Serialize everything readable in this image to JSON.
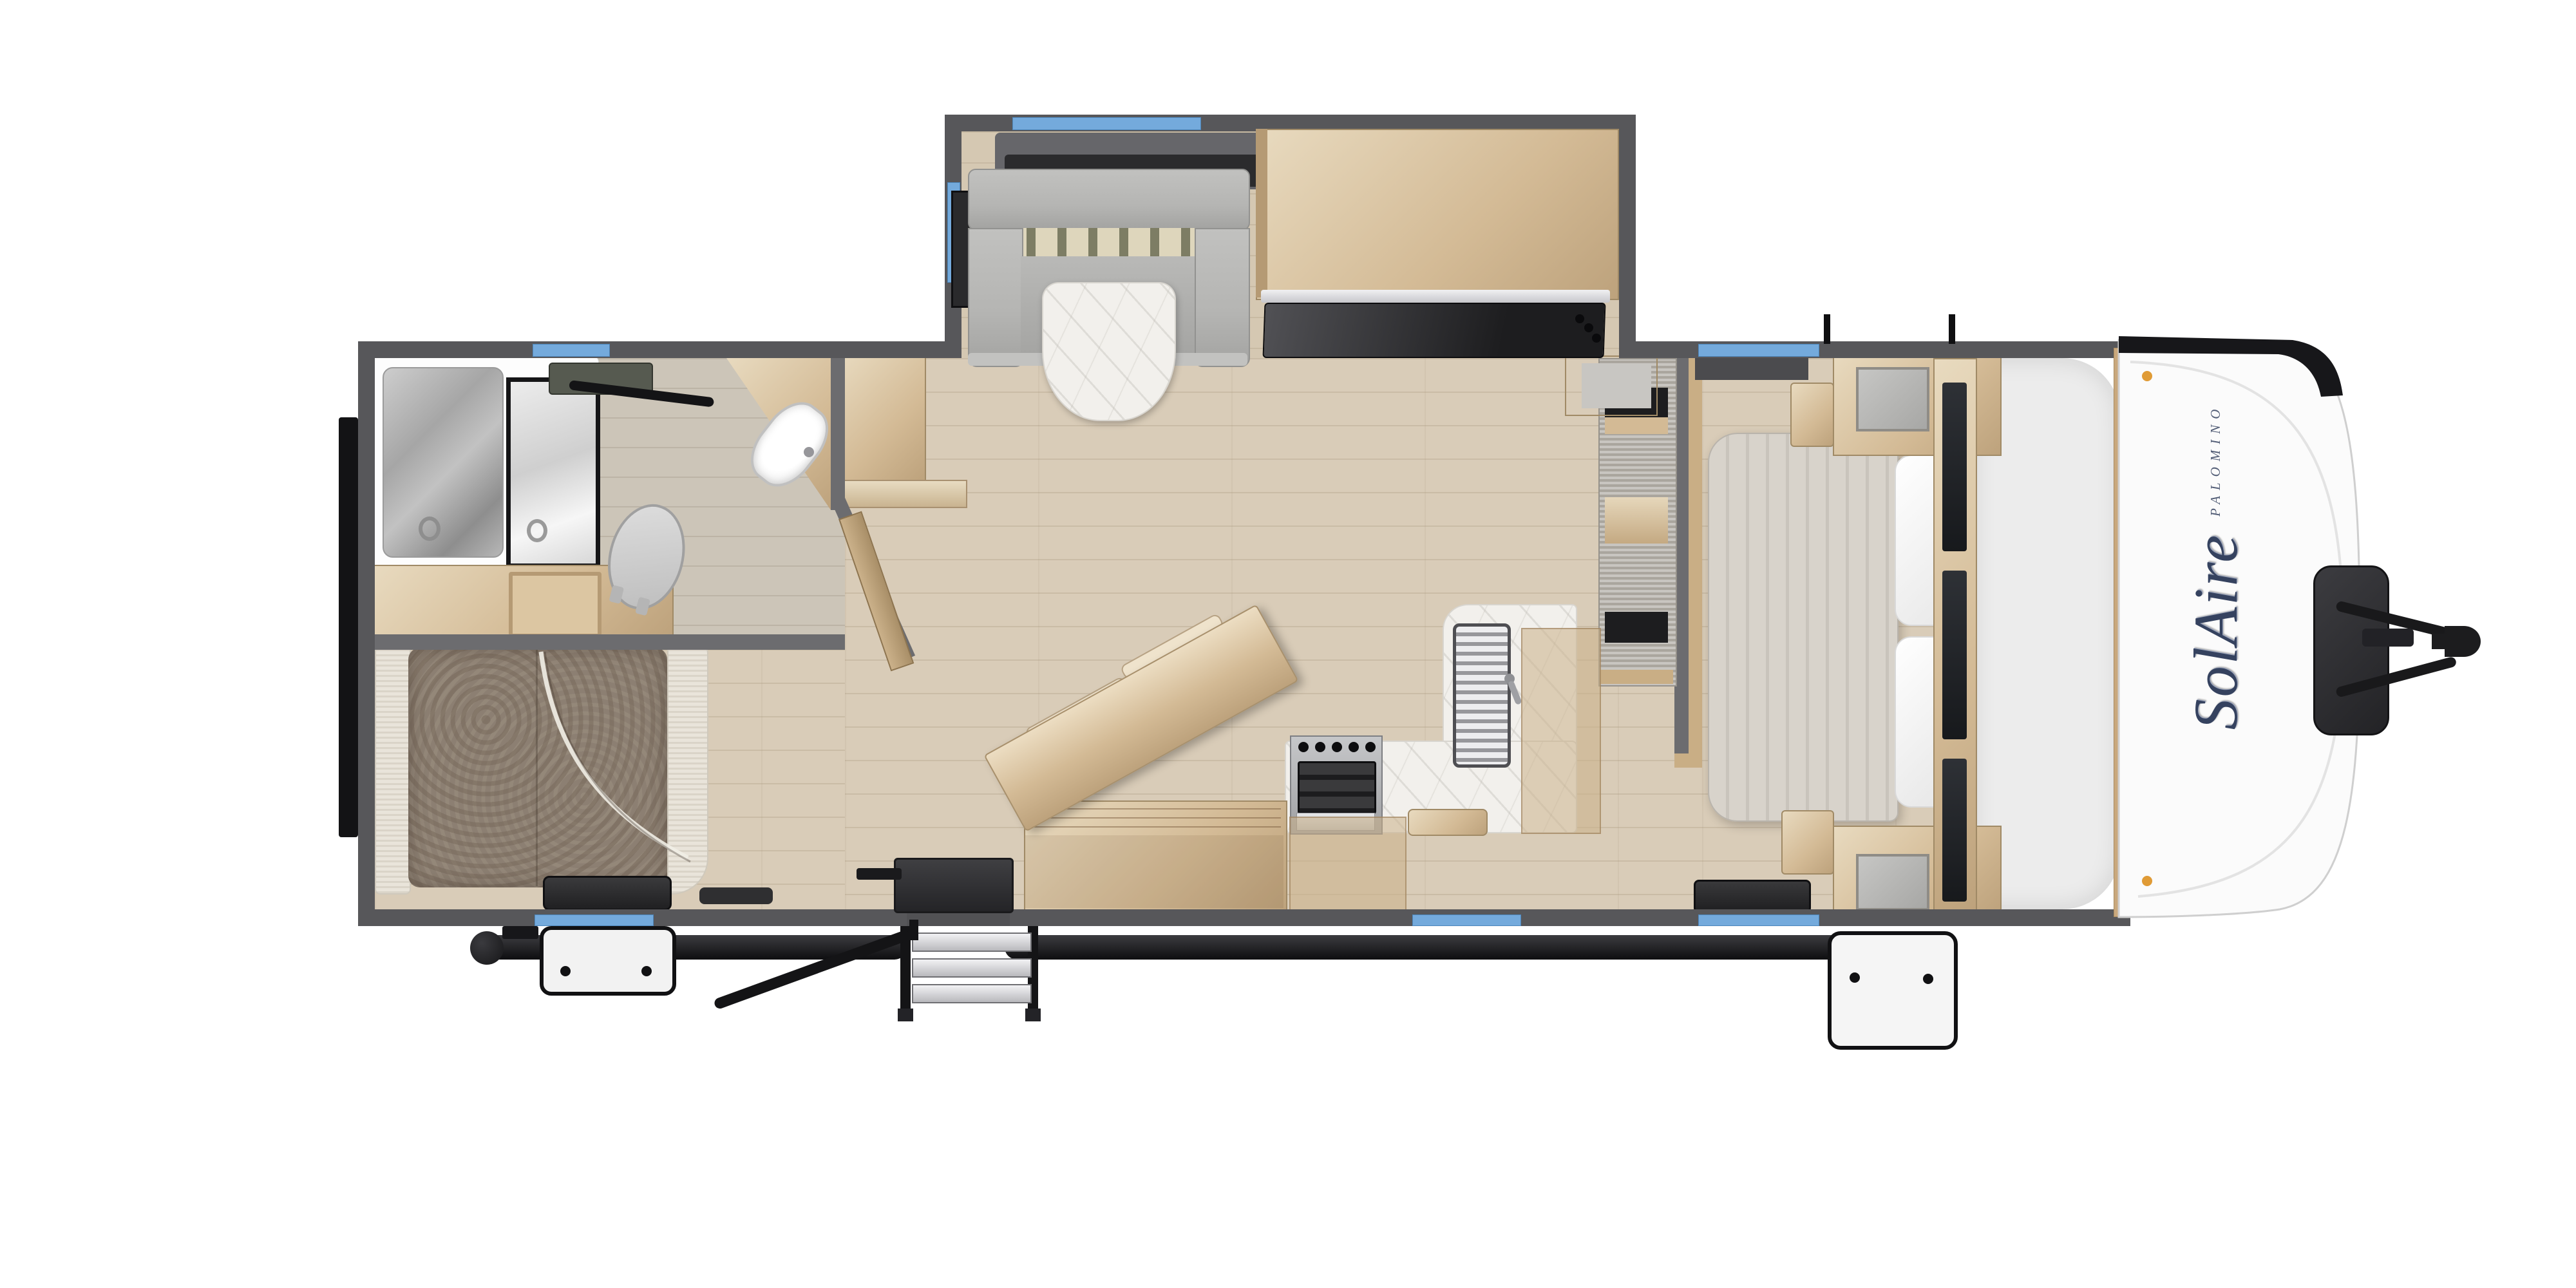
{
  "title": "Travel trailer floor plan (top-down rendering)",
  "brand": {
    "logo_text": "SolAire",
    "maker_text": "PALOMINO"
  },
  "colors": {
    "wall": "#57575a",
    "partition": "#6c6c6f",
    "floor": "#d9ccb8",
    "floor_bath": "#ccc5b8",
    "floor_slide": "#d5c8b2",
    "wood": "#d3ba95",
    "wood_light": "#e6d7bb",
    "wood_dark": "#b59a74",
    "counter": "#f2f0ec",
    "sofa": "#b5b5b3",
    "shag": "#8c7f72",
    "arm": "#e9e4da",
    "bed": "#d8d3cb",
    "window": "#74aadc",
    "navy": "#35425f",
    "black": "#161618",
    "storage": "#ececec",
    "amber_marker": "#e09b36"
  },
  "rooms": {
    "bathroom": {
      "fixtures": [
        "shower",
        "toilet",
        "corner-sink",
        "vanity",
        "roof-vent",
        "linen-cabinet"
      ]
    },
    "rear_lounge": {
      "fixtures": [
        "sofa-bed",
        "wall-tv"
      ]
    },
    "living_area": {
      "fixtures": [
        "u-dinette",
        "dinette-table",
        "slide-tv",
        "entertainment-cabinet",
        "entertainment-tv",
        "island-bar",
        "bar-stools",
        "storage-cabinet"
      ]
    },
    "kitchen": {
      "fixtures": [
        "range-oven",
        "sink",
        "faucet",
        "l-counter",
        "pantry",
        "overhead-cabinets",
        "cutting-board"
      ]
    },
    "bedroom": {
      "fixtures": [
        "bed",
        "pillows",
        "wardrobe-mirrors",
        "overhead-cabinets",
        "nightstands",
        "tv"
      ]
    }
  },
  "exterior": {
    "fixtures": [
      "dinette-slide-out",
      "entry-steps",
      "step-handrail",
      "awning-tube",
      "rear-bumper",
      "front-cap",
      "propane-tank-cover",
      "a-frame-hitch",
      "coupler",
      "windows",
      "roof-vents"
    ]
  },
  "window_count": 7
}
